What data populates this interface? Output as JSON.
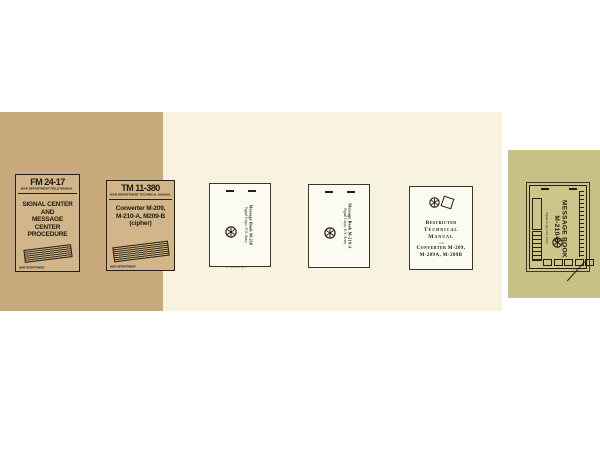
{
  "photo": {
    "background": "#ffffff",
    "panel_colors": {
      "tan": "#c9aa7c",
      "cream": "#f8f3df",
      "olive": "#c9c183"
    },
    "ink_color": "#241f14"
  },
  "books": {
    "fm24_17": {
      "doc_number": "FM 24-17",
      "manual_type": "WAR DEPARTMENT FIELD MANUAL",
      "title_lines": [
        "SIGNAL CENTER AND",
        "MESSAGE CENTER",
        "PROCEDURE"
      ],
      "footer_left": "WAR DEPARTMENT",
      "footer_right": "17 MARCH 1945"
    },
    "tm11_380": {
      "doc_number": "TM 11-380",
      "manual_type": "WAR DEPARTMENT TECHNICAL MANUAL",
      "title_lines": [
        "Converter M-209,",
        "M-210-A, M209-B",
        "(cipher)"
      ],
      "footer_left": "WAR DEPARTMENT",
      "footer_right": "17 MARCH 1944"
    },
    "m210": {
      "title": "Message Book M-210",
      "subtitle": "Signal Corps, U.S. Army"
    },
    "m210a": {
      "title": "Message Book M-210-A",
      "subtitle": "Signal Corps, U.S. Army"
    },
    "tm_restricted": {
      "line1": "Restricted",
      "line2": "Technical Manual",
      "line3": "and",
      "line4": "Converter M-209,",
      "line5": "M-209A, M-209B"
    },
    "m210b": {
      "title_line1": "MESSAGE BOOK",
      "title_line2": "M-210-B",
      "subtitle": "Signal Corps, U.S. Army"
    }
  }
}
